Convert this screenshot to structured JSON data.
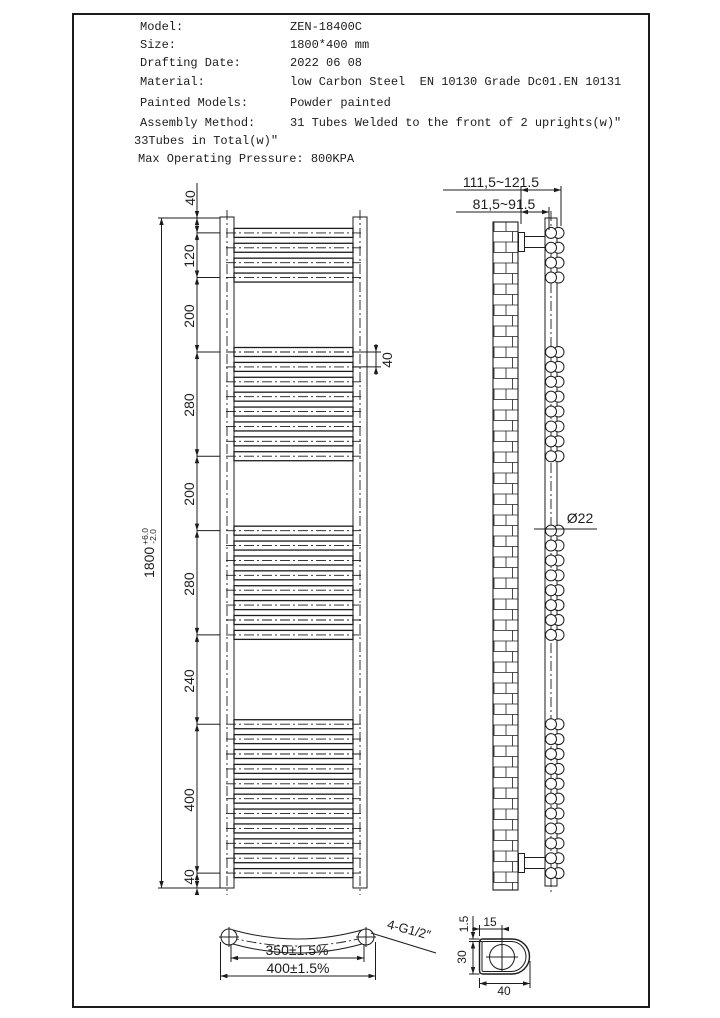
{
  "spec": {
    "rows": [
      {
        "label": "Model:",
        "value": "ZEN-18400C"
      },
      {
        "label": "Size:",
        "value": "1800*400 mm"
      },
      {
        "label": "Drafting Date:",
        "value": "2022 06 08"
      },
      {
        "label": "Material:",
        "value": "low Carbon Steel  EN 10130 Grade Dc01.EN 10131"
      },
      {
        "label": "Painted Models:",
        "value": "Powder painted"
      },
      {
        "label": "Assembly Method:",
        "value": "31 Tubes Welded to the front of 2 uprights(w)″"
      }
    ],
    "note": "33Tubes in Total(w)″",
    "pressure_line": "Max Operating Pressure: 800KPA"
  },
  "front_view": {
    "overall": {
      "value": "1800",
      "tol_plus": "+6.0",
      "tol_minus": "-2.0"
    },
    "segments": [
      "40",
      "120",
      "200",
      "280",
      "200",
      "280",
      "240",
      "400",
      "40"
    ],
    "segments_mm": [
      40,
      120,
      200,
      280,
      200,
      280,
      240,
      400,
      40
    ],
    "pitch_label": "40",
    "pitch_mm": 40,
    "tube_groups": [
      {
        "start_mm": 40,
        "count": 4
      },
      {
        "start_mm": 360,
        "count": 8
      },
      {
        "start_mm": 840,
        "count": 8
      },
      {
        "start_mm": 1360,
        "count": 11
      }
    ]
  },
  "side_view": {
    "bracket_depth_range": "111,5~121.5",
    "wall_gap_range": "81,5~91.5",
    "tube_diameter": "Ø22"
  },
  "bottom_view": {
    "tube_centres": "350±1.5%",
    "overall_width": "400±1.5%",
    "connections": "4-G1/2″"
  },
  "detail_view": {
    "wall_thickness": "1.5",
    "hole_offset": "15",
    "profile_depth": "30",
    "profile_width": "40"
  }
}
